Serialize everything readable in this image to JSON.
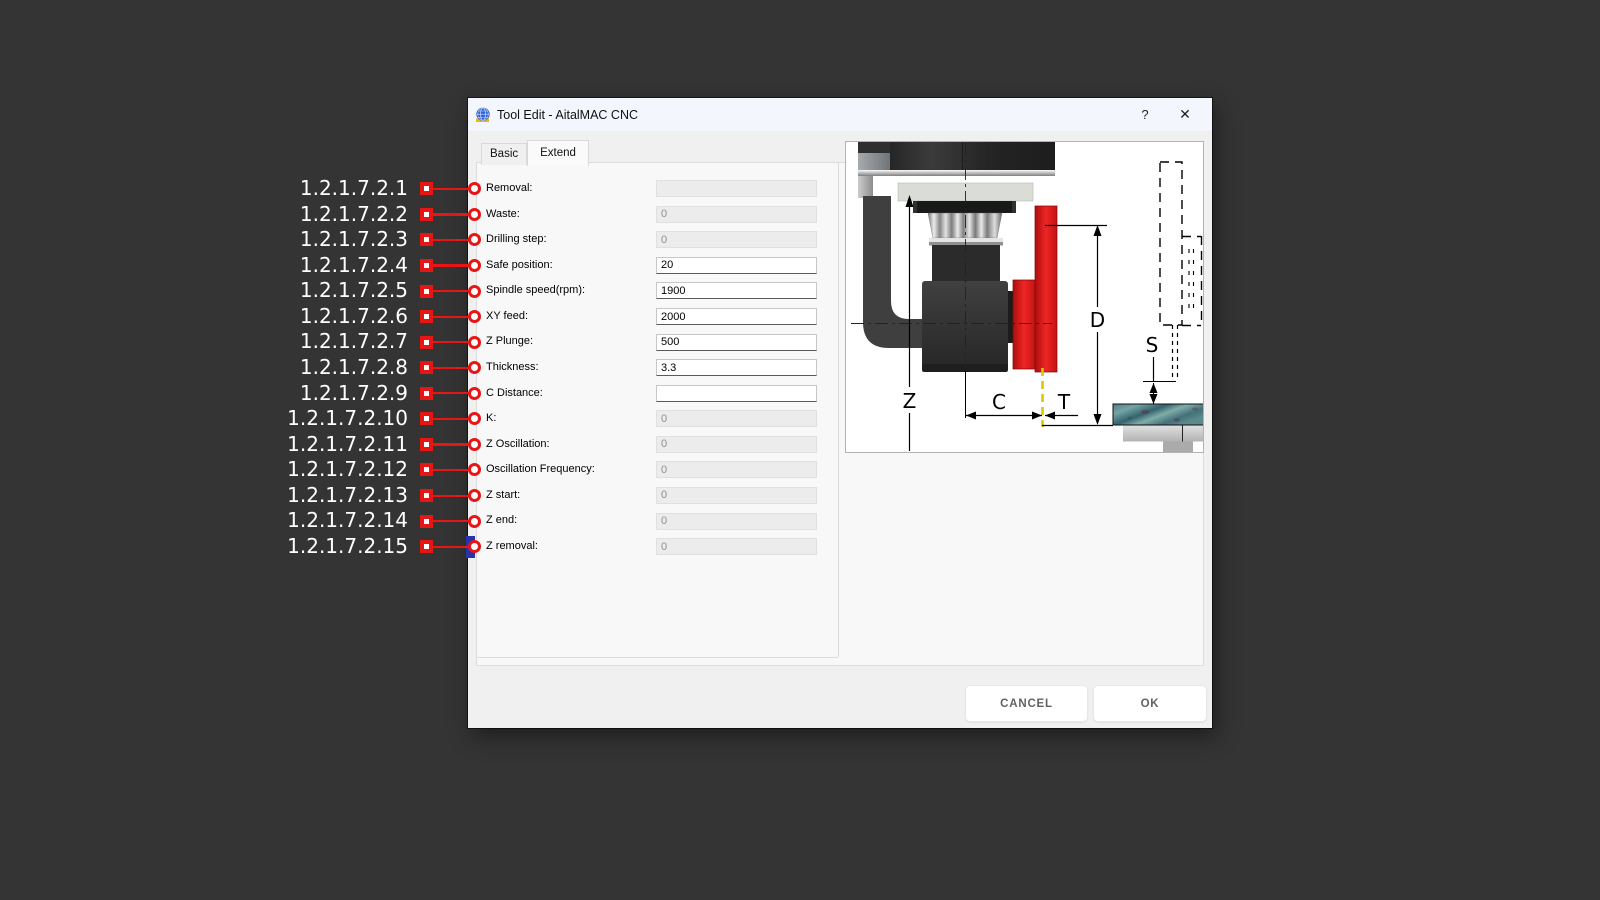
{
  "window": {
    "title": "Tool Edit - AitalMAC CNC",
    "help_label": "?",
    "close_label": "✕"
  },
  "tabs": [
    {
      "label": "Basic",
      "active": false
    },
    {
      "label": "Extend",
      "active": true
    }
  ],
  "fields": [
    {
      "ref": "1.2.1.7.2.1",
      "label": "Removal:",
      "value": "",
      "enabled": false
    },
    {
      "ref": "1.2.1.7.2.2",
      "label": "Waste:",
      "value": "0",
      "enabled": false
    },
    {
      "ref": "1.2.1.7.2.3",
      "label": "Drilling step:",
      "value": "0",
      "enabled": false
    },
    {
      "ref": "1.2.1.7.2.4",
      "label": "Safe position:",
      "value": "20",
      "enabled": true
    },
    {
      "ref": "1.2.1.7.2.5",
      "label": "Spindle speed(rpm):",
      "value": "1900",
      "enabled": true
    },
    {
      "ref": "1.2.1.7.2.6",
      "label": "XY feed:",
      "value": "2000",
      "enabled": true
    },
    {
      "ref": "1.2.1.7.2.7",
      "label": "Z Plunge:",
      "value": "500",
      "enabled": true
    },
    {
      "ref": "1.2.1.7.2.8",
      "label": "Thickness:",
      "value": "3.3",
      "enabled": true
    },
    {
      "ref": "1.2.1.7.2.9",
      "label": "C Distance:",
      "value": "",
      "enabled": true
    },
    {
      "ref": "1.2.1.7.2.10",
      "label": "K:",
      "value": "0",
      "enabled": false
    },
    {
      "ref": "1.2.1.7.2.11",
      "label": "Z Oscillation:",
      "value": "0",
      "enabled": false
    },
    {
      "ref": "1.2.1.7.2.12",
      "label": "Oscillation Frequency:",
      "value": "0",
      "enabled": false
    },
    {
      "ref": "1.2.1.7.2.13",
      "label": "Z start:",
      "value": "0",
      "enabled": false
    },
    {
      "ref": "1.2.1.7.2.14",
      "label": "Z end:",
      "value": "0",
      "enabled": false
    },
    {
      "ref": "1.2.1.7.2.15",
      "label": "Z removal:",
      "value": "0",
      "enabled": false
    }
  ],
  "buttons": {
    "cancel": "CANCEL",
    "ok": "OK"
  },
  "diagram": {
    "labels": {
      "z": "Z",
      "c": "C",
      "t": "T",
      "d": "D",
      "s": "S"
    }
  },
  "colors": {
    "annotation_red": "#e81515",
    "blade_red": "#e02020",
    "cut_line_yellow": "#d9ca00",
    "material_teal": "#4f8289",
    "focus_blue": "#2733ad",
    "dialog_bg": "#f0f0f0",
    "titlebar_bg": "#f3f6fc"
  }
}
